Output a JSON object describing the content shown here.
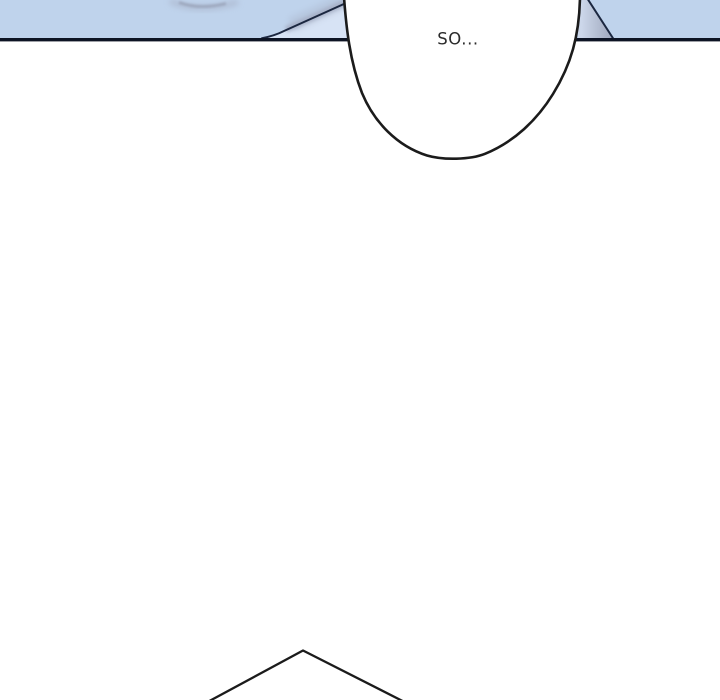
{
  "panel": {
    "type": "webtoon-comic-panel",
    "dialogue": {
      "text": "SO..."
    },
    "colors": {
      "background": "#ffffff",
      "sky": "#bfd3ec",
      "fold_light": "#d7e3f5",
      "fold_shadow": "#a6afc5",
      "crease_shadow": "#97a0b6",
      "panel_line": "#0d1424",
      "fold_line": "#1b2740",
      "ink": "#1b1b1b",
      "bubble_fill": "#ffffff",
      "wedge_grad_light": "#ccd7ea",
      "wedge_grad_dark": "#a2abc0",
      "text": "#2b2b2b"
    }
  }
}
